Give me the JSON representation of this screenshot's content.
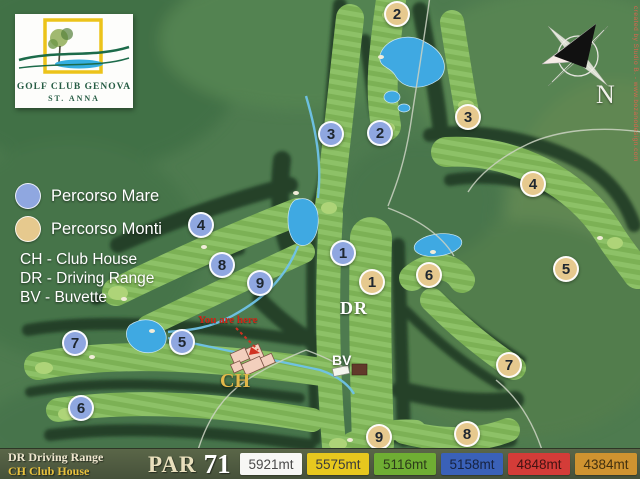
{
  "logo": {
    "title": "GOLF CLUB GENOVA",
    "subtitle": "ST. ANNA"
  },
  "legend": {
    "items": [
      {
        "label": "Percorso Mare",
        "color": "#8fa7e0"
      },
      {
        "label": "Percorso Monti",
        "color": "#e6c98e"
      }
    ],
    "abbreviations": [
      {
        "line": "CH - Club House"
      },
      {
        "line": "DR - Driving Range"
      },
      {
        "line": "BV - Buvette"
      }
    ]
  },
  "map": {
    "labels": {
      "driving_range": "DR",
      "buvette": "BV",
      "club_house": "CH",
      "you_are_here": "You are here",
      "north": "N"
    },
    "credit": "created by Studio B. - www.bozanodesign.com",
    "marker_colors": {
      "mare": "#8fa7e0",
      "monti": "#e6c98e"
    },
    "markers": [
      {
        "course": "mare",
        "number": "1",
        "x": 343,
        "y": 253
      },
      {
        "course": "mare",
        "number": "2",
        "x": 380,
        "y": 133
      },
      {
        "course": "mare",
        "number": "3",
        "x": 331,
        "y": 134
      },
      {
        "course": "mare",
        "number": "4",
        "x": 201,
        "y": 225
      },
      {
        "course": "mare",
        "number": "5",
        "x": 182,
        "y": 342
      },
      {
        "course": "mare",
        "number": "6",
        "x": 81,
        "y": 408
      },
      {
        "course": "mare",
        "number": "7",
        "x": 75,
        "y": 343
      },
      {
        "course": "mare",
        "number": "8",
        "x": 222,
        "y": 265
      },
      {
        "course": "mare",
        "number": "9",
        "x": 260,
        "y": 283
      },
      {
        "course": "monti",
        "number": "1",
        "x": 372,
        "y": 282
      },
      {
        "course": "monti",
        "number": "2",
        "x": 397,
        "y": 14
      },
      {
        "course": "monti",
        "number": "3",
        "x": 468,
        "y": 117
      },
      {
        "course": "monti",
        "number": "4",
        "x": 533,
        "y": 184
      },
      {
        "course": "monti",
        "number": "5",
        "x": 566,
        "y": 269
      },
      {
        "course": "monti",
        "number": "6",
        "x": 429,
        "y": 275
      },
      {
        "course": "monti",
        "number": "7",
        "x": 509,
        "y": 365
      },
      {
        "course": "monti",
        "number": "8",
        "x": 467,
        "y": 434
      },
      {
        "course": "monti",
        "number": "9",
        "x": 379,
        "y": 437
      }
    ]
  },
  "footer": {
    "abbrev_line1": "DR Driving Range",
    "abbrev_line2": "CH Club House",
    "par_label": "PAR",
    "par_value": "71",
    "tees": [
      {
        "name": "white",
        "distance": "5921mt",
        "bg": "#f7f7f5",
        "fg": "#4a4a4a"
      },
      {
        "name": "yellow",
        "distance": "5575mt",
        "bg": "#e7c81e",
        "fg": "#3b3b3b"
      },
      {
        "name": "green",
        "distance": "5116mt",
        "bg": "#6fae33",
        "fg": "#2c3b1a"
      },
      {
        "name": "blue",
        "distance": "5158mt",
        "bg": "#3a61b8",
        "fg": "#16223f"
      },
      {
        "name": "red",
        "distance": "4848mt",
        "bg": "#d43c38",
        "fg": "#431312"
      },
      {
        "name": "orange",
        "distance": "4384mt",
        "bg": "#cf9330",
        "fg": "#42300f"
      }
    ]
  }
}
